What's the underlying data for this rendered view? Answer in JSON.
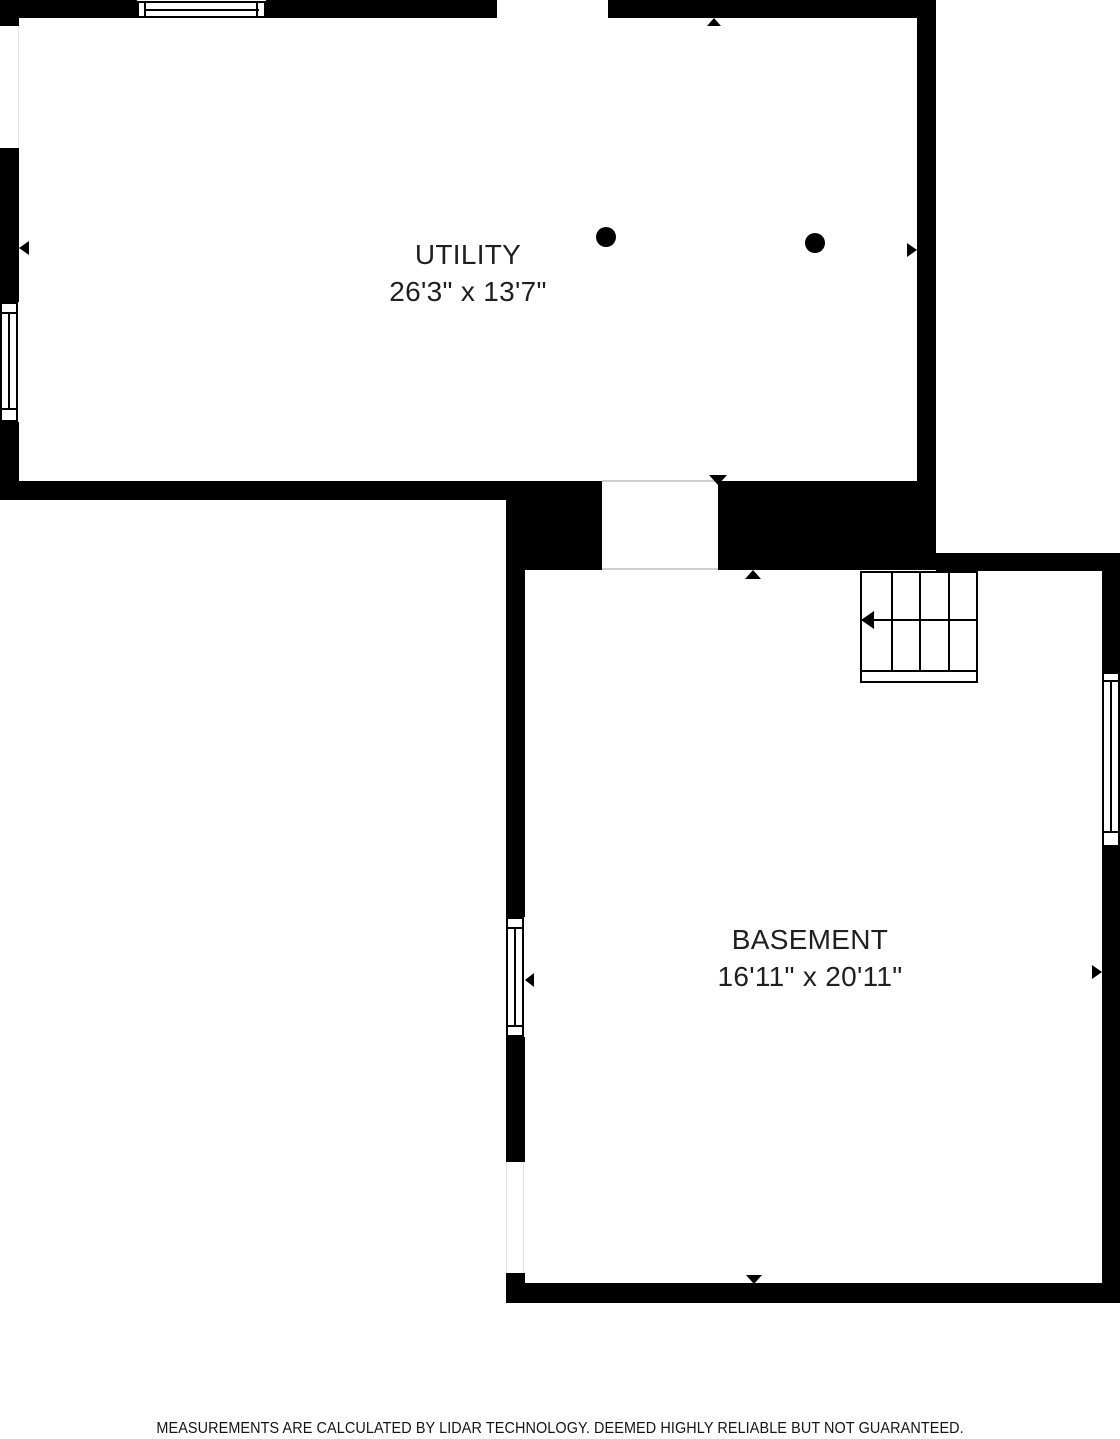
{
  "title": "Basement Floor Plan",
  "colors": {
    "wall": "#000000",
    "background": "#ffffff",
    "label_text": "#1f1f1f",
    "opening_line": "#cfcfcf"
  },
  "rooms": {
    "utility": {
      "name": "UTILITY",
      "dimensions": "26'3\" x 13'7\""
    },
    "basement": {
      "name": "BASEMENT",
      "dimensions": "16'11\" x 20'11\""
    }
  },
  "footer": {
    "disclaimer": "MEASUREMENTS ARE CALCULATED BY LIDAR TECHNOLOGY. DEEMED HIGHLY RELIABLE BUT NOT GUARANTEED."
  },
  "icons": {
    "column-dot-icon": "filled black circle",
    "entry-arrow-icon": "small solid triangle marking opening direction",
    "stair-direction-arrow-icon": "left-pointing arrow with shaft",
    "window-icon": "white inset rectangle with frame lines in wall",
    "stairs-icon": "stair tread grid"
  },
  "markers": {
    "utility_column_dots": 2,
    "stairs": {
      "treads": 4,
      "direction": "left"
    }
  }
}
